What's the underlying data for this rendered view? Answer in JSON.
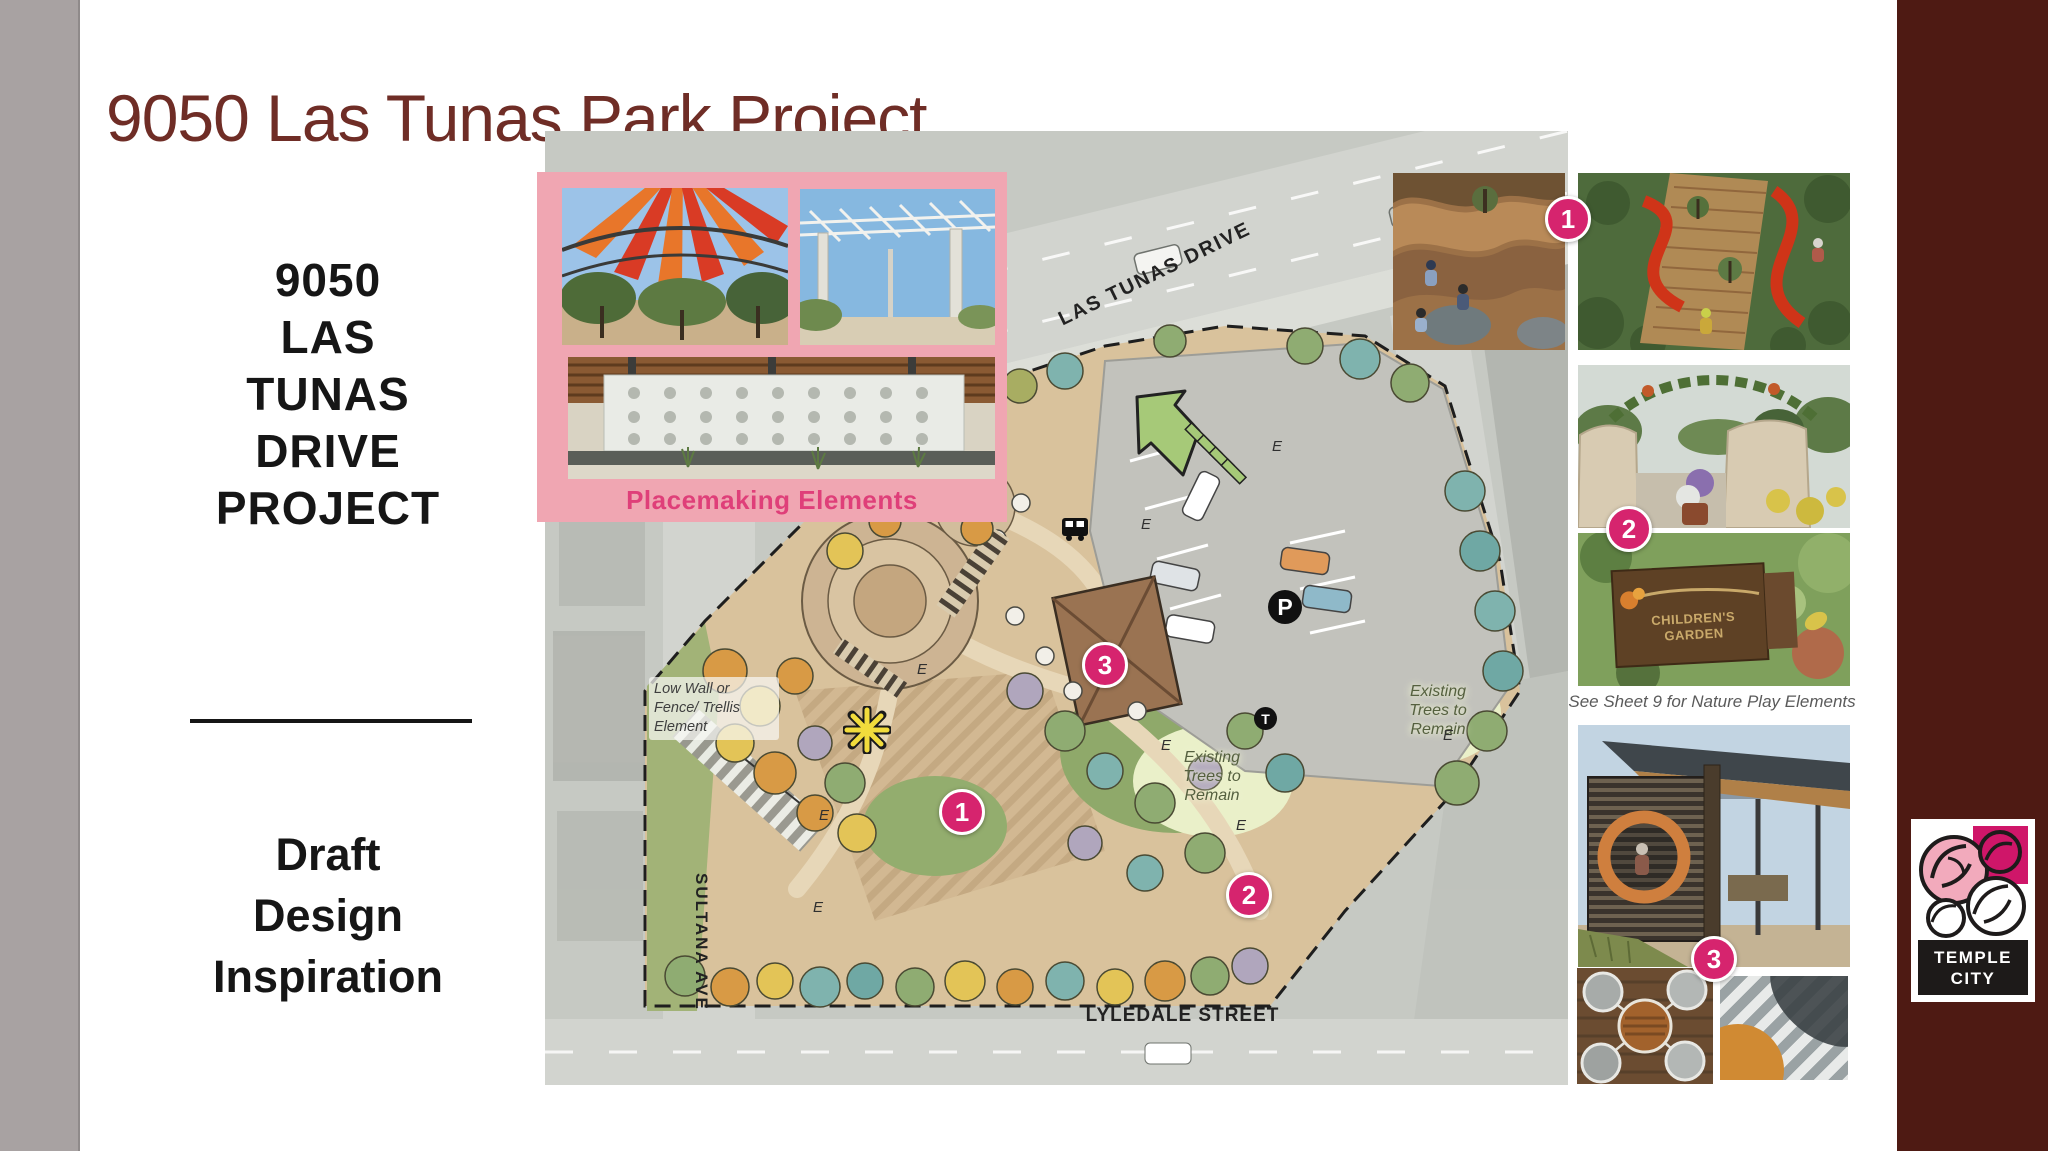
{
  "slide": {
    "title": "9050 Las Tunas Park Project"
  },
  "sidebar": {
    "project_lines": [
      "9050",
      "LAS",
      "TUNAS",
      "DRIVE",
      "PROJECT"
    ],
    "subtitle_lines": [
      "Draft",
      "Design",
      "Inspiration"
    ]
  },
  "placemaking": {
    "caption": "Placemaking Elements"
  },
  "map": {
    "street_top": "LAS TUNAS DRIVE",
    "street_left": "SULTANA AVE",
    "street_bottom": "LYLEDALE STREET",
    "parking_symbol": "P",
    "transit_symbol": "T",
    "existing_tree_symbol": "E",
    "annotation_lines": [
      "Low Wall or",
      "Fence/ Trellis",
      "Element"
    ],
    "existing_trees_label_lines": [
      "Existing",
      "Trees to",
      "Remain"
    ],
    "markers": {
      "plaza": "1",
      "nature_play": "2",
      "pavilion": "3"
    }
  },
  "inspiration": {
    "badge_1": "1",
    "badge_2": "2",
    "badge_3": "3",
    "sheet_note": "See Sheet 9 for Nature Play Elements",
    "sign_lines": [
      "CHILDREN'S",
      "GARDEN"
    ]
  },
  "logo": {
    "line1": "TEMPLE",
    "line2": "CITY"
  },
  "colors": {
    "band_left": "#a8a2a2",
    "band_right": "#4e1a13",
    "title_red": "#6f2d26",
    "panel_pink": "#f0a6b2",
    "caption_pink": "#df3f79",
    "badge_pink": "#d6246e"
  }
}
